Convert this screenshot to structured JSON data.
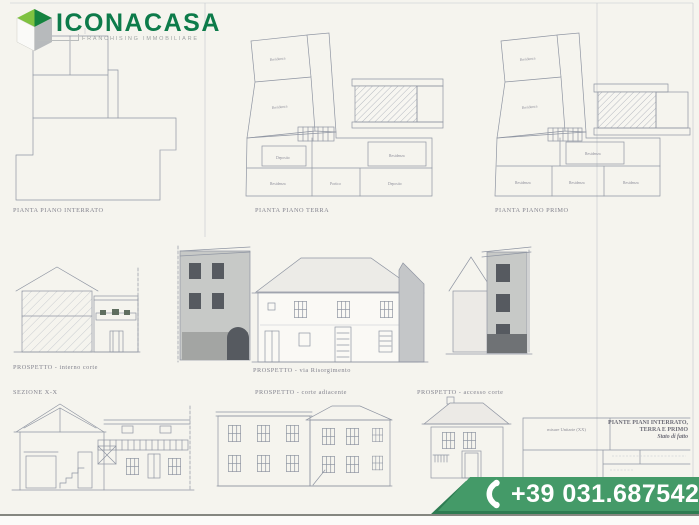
{
  "logo": {
    "brand": "ICONACASA",
    "tagline": "FRANCHISING IMMOBILIARE"
  },
  "drawings": {
    "plan_interrato_label": "PIANTA PIANO INTERRATO",
    "plan_terra_label": "PIANTA PIANO TERRA",
    "plan_primo_label": "PIANTA PIANO PRIMO",
    "prospetto_interno_corte_label": "PROSPETTO - interno corte",
    "prospetto_via_risorgimento_label": "PROSPETTO - via Risorgimento",
    "sezione_label": "SEZIONE X-X",
    "prospetto_corte_adiacente_label": "PROSPETTO - corte adiacente",
    "prospetto_accesso_corte_label": "PROSPETTO - accesso corte"
  },
  "plans": {
    "terra_rooms": [
      "Residenza",
      "Residenza",
      "Deposito",
      "Residenza",
      "Residenza",
      "Portico",
      "Deposito"
    ],
    "primo_rooms": [
      "Residenza",
      "Residenza",
      "Residenza",
      "Residenza",
      "Residenza",
      "Residenza"
    ]
  },
  "title_block": {
    "note": "misure Unitarie (XX)",
    "title_line1": "PIANTE PIANI INTERRATO,",
    "title_line2": "TERRA E  PRIMO",
    "subtitle": "Stato di fatto"
  },
  "contact": {
    "phone": "+39 031.6875427"
  },
  "colors": {
    "brand_green": "#0d7b4a",
    "cube_green_light": "#7fc241",
    "cube_green_dark": "#15833f",
    "banner_green": "#449a68",
    "banner_green_dark": "#2e7c52",
    "paper": "#f5f4ee",
    "drawing_line": "#8f95a2"
  }
}
